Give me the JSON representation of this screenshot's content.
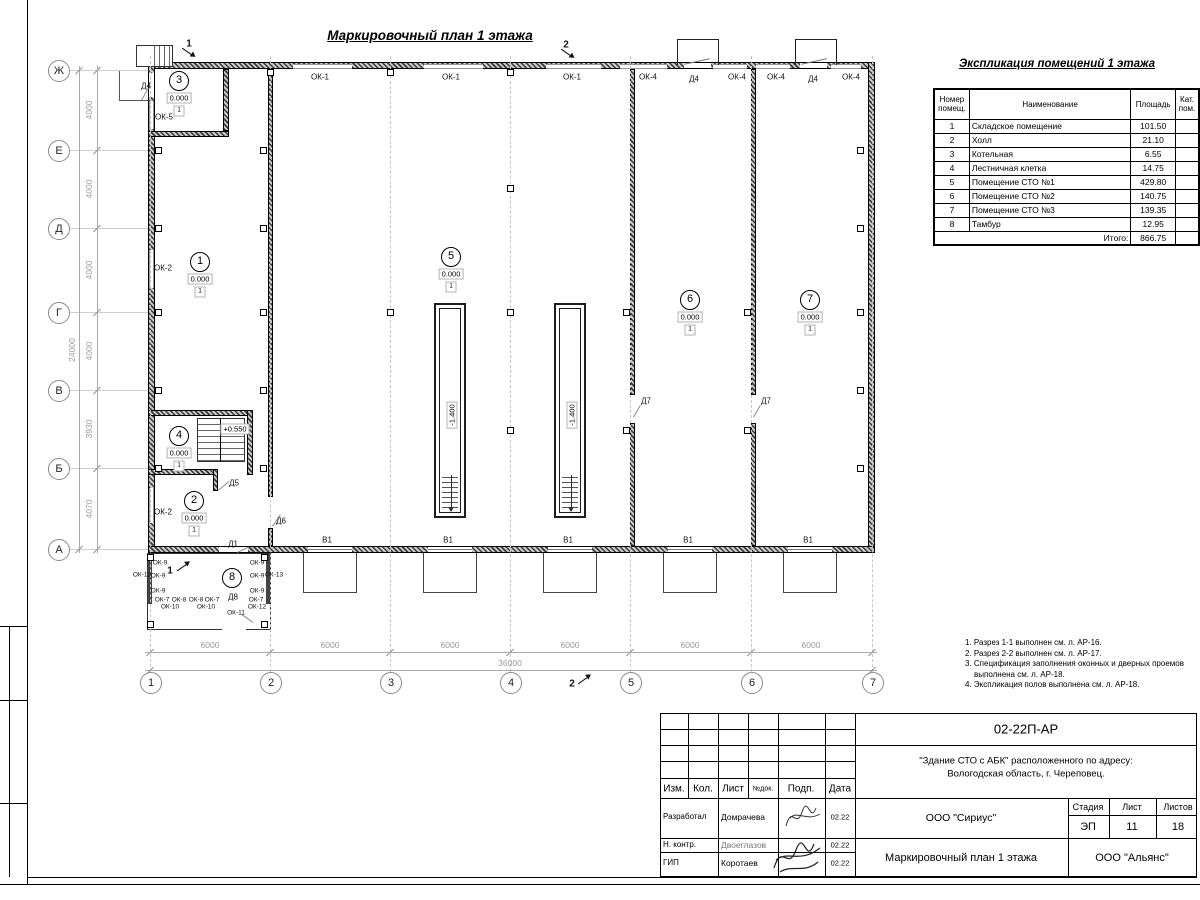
{
  "sheet": {
    "plan_title": "Маркировочный план 1 этажа",
    "explication": {
      "title": "Экспликация помещений 1 этажа",
      "headers": [
        "Номер помещ.",
        "Наименование",
        "Площадь",
        "Кат. пом."
      ],
      "rows": [
        [
          "1",
          "Складское помещение",
          "101.50",
          ""
        ],
        [
          "2",
          "Холл",
          "21.10",
          ""
        ],
        [
          "3",
          "Котельная",
          "6.55",
          ""
        ],
        [
          "4",
          "Лестничная клетка",
          "14.75",
          ""
        ],
        [
          "5",
          "Помещение СТО №1",
          "429.80",
          ""
        ],
        [
          "6",
          "Помещение СТО №2",
          "140.75",
          ""
        ],
        [
          "7",
          "Помещение СТО №3",
          "139.35",
          ""
        ],
        [
          "8",
          "Тамбур",
          "12.95",
          ""
        ]
      ],
      "total_label": "Итого:",
      "total_value": "866.75"
    },
    "notes": [
      "1. Разрез 1-1 выполнен см. л. АР-16.",
      "2. Разрез 2-2 выполнен см. л. АР-17.",
      "3. Спецификация заполнения оконных и дверных проемов выполнена см. л. АР-18.",
      "4. Экспликация полов выполнена см. л. АР-18."
    ],
    "title_block": {
      "doc_number": "02-22П-АР",
      "object_line1": "\"Здание СТО с АБК\" расположенного по адресу:",
      "object_line2": "Вологодская область, г. Череповец.",
      "header_cols": [
        "Изм.",
        "Кол.",
        "Лист",
        "№док.",
        "Подп.",
        "Дата"
      ],
      "rows": [
        {
          "role": "Разработал",
          "name": "Домрачева",
          "date": "02.22"
        },
        {
          "role": "Н. контр.",
          "name": "Двоеглазов",
          "date": "02.22"
        },
        {
          "role": "ГИП",
          "name": "Коротаев",
          "date": "02.22"
        }
      ],
      "company": "ООО \"Сириус\"",
      "stage_label": "Стадия",
      "sheet_label": "Лист",
      "sheets_label": "Листов",
      "stage": "ЭП",
      "sheet_no": "11",
      "sheets_total": "18",
      "drawing_title": "Маркировочный план 1 этажа",
      "contractor": "ООО \"Альянс\""
    }
  },
  "plan": {
    "elev": "0.000",
    "floor_mark": "1",
    "pit_elev": "-1.400",
    "stair_elev": "+0.550",
    "axes_rows": [
      {
        "label": "Ж",
        "y": 70
      },
      {
        "label": "Е",
        "y": 150
      },
      {
        "label": "Д",
        "y": 228
      },
      {
        "label": "Г",
        "y": 312
      },
      {
        "label": "В",
        "y": 390
      },
      {
        "label": "Б",
        "y": 468
      },
      {
        "label": "А",
        "y": 549
      }
    ],
    "axes_cols": [
      {
        "label": "1",
        "x": 150
      },
      {
        "label": "2",
        "x": 270
      },
      {
        "label": "3",
        "x": 390
      },
      {
        "label": "4",
        "x": 510
      },
      {
        "label": "5",
        "x": 630
      },
      {
        "label": "6",
        "x": 751
      },
      {
        "label": "7",
        "x": 872
      }
    ],
    "dims_left": [
      {
        "t": "4000",
        "y": 110
      },
      {
        "t": "4000",
        "y": 189
      },
      {
        "t": "4000",
        "y": 270
      },
      {
        "t": "4000",
        "y": 351
      },
      {
        "t": "3930",
        "y": 429
      },
      {
        "t": "4070",
        "y": 509
      }
    ],
    "dim_left_total": "24000",
    "dims_bottom": [
      {
        "t": "6000",
        "x": 210
      },
      {
        "t": "6000",
        "x": 330
      },
      {
        "t": "6000",
        "x": 450
      },
      {
        "t": "6000",
        "x": 570
      },
      {
        "t": "6000",
        "x": 690
      },
      {
        "t": "6000",
        "x": 811
      }
    ],
    "dim_bottom_total": "36000",
    "labels": [
      {
        "t": "ОК-1",
        "x": 320,
        "y": 77
      },
      {
        "t": "ОК-1",
        "x": 451,
        "y": 77
      },
      {
        "t": "ОК-1",
        "x": 572,
        "y": 77
      },
      {
        "t": "ОК-4",
        "x": 648,
        "y": 77
      },
      {
        "t": "Д4",
        "x": 694,
        "y": 79
      },
      {
        "t": "ОК-4",
        "x": 737,
        "y": 77
      },
      {
        "t": "ОК-4",
        "x": 776,
        "y": 77
      },
      {
        "t": "Д4",
        "x": 813,
        "y": 79
      },
      {
        "t": "ОК-4",
        "x": 851,
        "y": 77
      },
      {
        "t": "Д4",
        "x": 146,
        "y": 86
      },
      {
        "t": "ОК-5",
        "x": 164,
        "y": 117
      },
      {
        "t": "ОК-2",
        "x": 163,
        "y": 268
      },
      {
        "t": "ОК-2",
        "x": 163,
        "y": 512
      },
      {
        "t": "Д5",
        "x": 234,
        "y": 483
      },
      {
        "t": "Д6",
        "x": 281,
        "y": 521
      },
      {
        "t": "Д1",
        "x": 233,
        "y": 544
      },
      {
        "t": "Д7",
        "x": 646,
        "y": 401
      },
      {
        "t": "Д7",
        "x": 766,
        "y": 401
      },
      {
        "t": "Д8",
        "x": 233,
        "y": 597
      },
      {
        "t": "В1",
        "x": 327,
        "y": 540
      },
      {
        "t": "В1",
        "x": 448,
        "y": 540
      },
      {
        "t": "В1",
        "x": 568,
        "y": 540
      },
      {
        "t": "В1",
        "x": 688,
        "y": 540
      },
      {
        "t": "В1",
        "x": 808,
        "y": 540
      },
      {
        "t": "ОК-13",
        "x": 142,
        "y": 575,
        "c": "s"
      },
      {
        "t": "ОК-13",
        "x": 274,
        "y": 575,
        "c": "s"
      },
      {
        "t": "ОК-9",
        "x": 160,
        "y": 563,
        "c": "s"
      },
      {
        "t": "ОК-9",
        "x": 158,
        "y": 576,
        "c": "s"
      },
      {
        "t": "ОК-9",
        "x": 158,
        "y": 591,
        "c": "s"
      },
      {
        "t": "ОК-7",
        "x": 162,
        "y": 600,
        "c": "s"
      },
      {
        "t": "ОК-8",
        "x": 179,
        "y": 600,
        "c": "s"
      },
      {
        "t": "ОК-8",
        "x": 196,
        "y": 600,
        "c": "s"
      },
      {
        "t": "ОК-7",
        "x": 212,
        "y": 600,
        "c": "s"
      },
      {
        "t": "ОК-10",
        "x": 170,
        "y": 607,
        "c": "s"
      },
      {
        "t": "ОК-10",
        "x": 206,
        "y": 607,
        "c": "s"
      },
      {
        "t": "ОК-11",
        "x": 236,
        "y": 613,
        "c": "s"
      },
      {
        "t": "ОК-9",
        "x": 257,
        "y": 563,
        "c": "s"
      },
      {
        "t": "ОК-9",
        "x": 257,
        "y": 576,
        "c": "s"
      },
      {
        "t": "ОК-9",
        "x": 257,
        "y": 591,
        "c": "s"
      },
      {
        "t": "ОК-7",
        "x": 256,
        "y": 600,
        "c": "s"
      },
      {
        "t": "ОК-12",
        "x": 257,
        "y": 607,
        "c": "s"
      },
      {
        "t": "1",
        "x": 189,
        "y": 44,
        "c": "sect"
      },
      {
        "t": "1",
        "x": 170,
        "y": 571,
        "c": "sect"
      },
      {
        "t": "2",
        "x": 566,
        "y": 45,
        "c": "sect"
      },
      {
        "t": "2",
        "x": 572,
        "y": 684,
        "c": "sect"
      }
    ],
    "room_markers": [
      {
        "n": "1",
        "x": 200,
        "y": 262,
        "e": true
      },
      {
        "n": "2",
        "x": 194,
        "y": 501,
        "e": true
      },
      {
        "n": "3",
        "x": 179,
        "y": 81,
        "e": true
      },
      {
        "n": "4",
        "x": 179,
        "y": 436,
        "e": true
      },
      {
        "n": "5",
        "x": 451,
        "y": 257,
        "e": true
      },
      {
        "n": "6",
        "x": 690,
        "y": 300,
        "e": true
      },
      {
        "n": "7",
        "x": 810,
        "y": 300,
        "e": true
      },
      {
        "n": "8",
        "x": 232,
        "y": 578,
        "e": false
      }
    ]
  }
}
